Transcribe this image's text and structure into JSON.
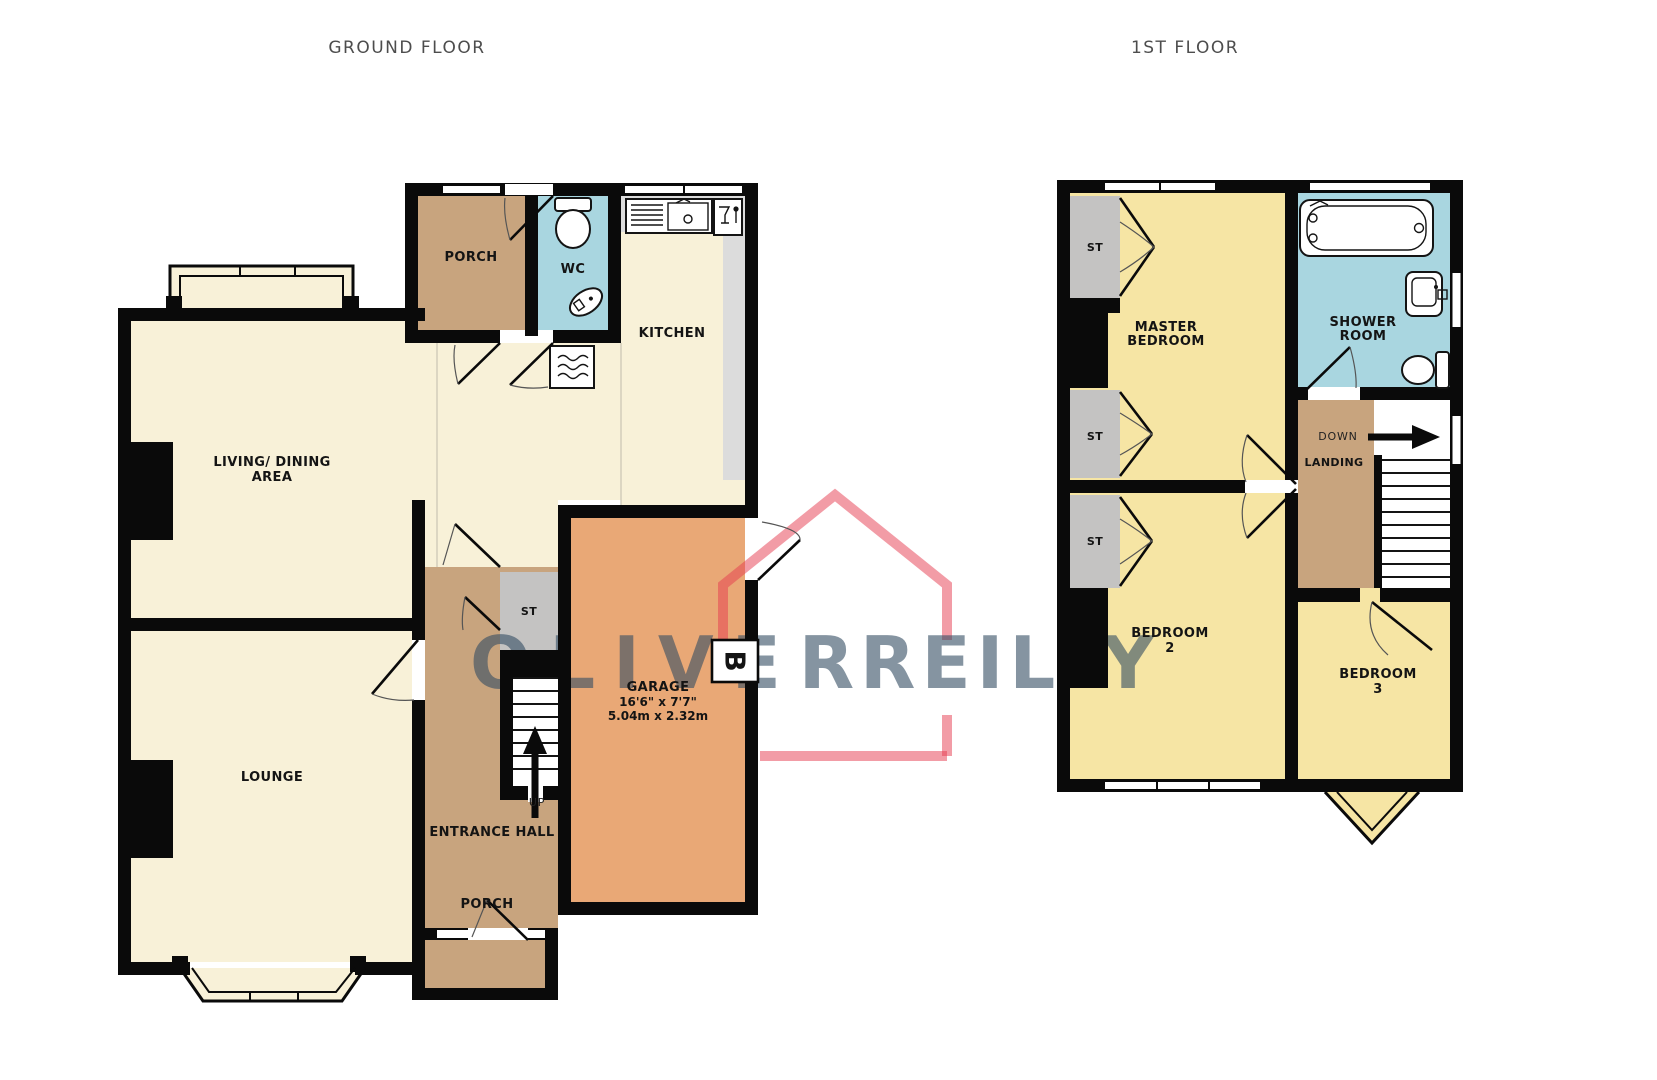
{
  "titles": {
    "ground": "GROUND FLOOR",
    "first": "1ST FLOOR"
  },
  "gf": {
    "porch_top": "PORCH",
    "wc": "WC",
    "kitchen": "KITCHEN",
    "living1": "LIVING/ DINING",
    "living2": "AREA",
    "st": "ST",
    "lounge": "LOUNGE",
    "garage1": "GARAGE",
    "garage2": "16'6\" x 7'7\"",
    "garage3": "5.04m x 2.32m",
    "up": "UP",
    "hall": "ENTRANCE HALL",
    "porch_bottom": "PORCH",
    "boiler": "B"
  },
  "ff": {
    "st1": "ST",
    "st2": "ST",
    "st3": "ST",
    "master1": "MASTER",
    "master2": "BEDROOM",
    "shower1": "SHOWER",
    "shower2": "ROOM",
    "down": "DOWN",
    "landing": "LANDING",
    "bed2a": "BEDROOM",
    "bed2b": "2",
    "bed3a": "BEDROOM",
    "bed3b": "3"
  },
  "watermark": {
    "word1": "OLIVER",
    "word2": "REILLY"
  },
  "colors": {
    "wall": "#0a0a0a",
    "gf_room_cream": "#f8f1d8",
    "ff_room_yellow": "#f6e5a4",
    "hall_tan": "#c8a47e",
    "wet_room_blue": "#a9d6e0",
    "storage_gray": "#c4c3c2",
    "kitchen_counter": "#dcdcdc",
    "garage_orange": "#e9a876",
    "watermark_pink": "rgba(230,57,78,0.5)",
    "watermark_text": "rgba(52,76,99,0.6)"
  }
}
